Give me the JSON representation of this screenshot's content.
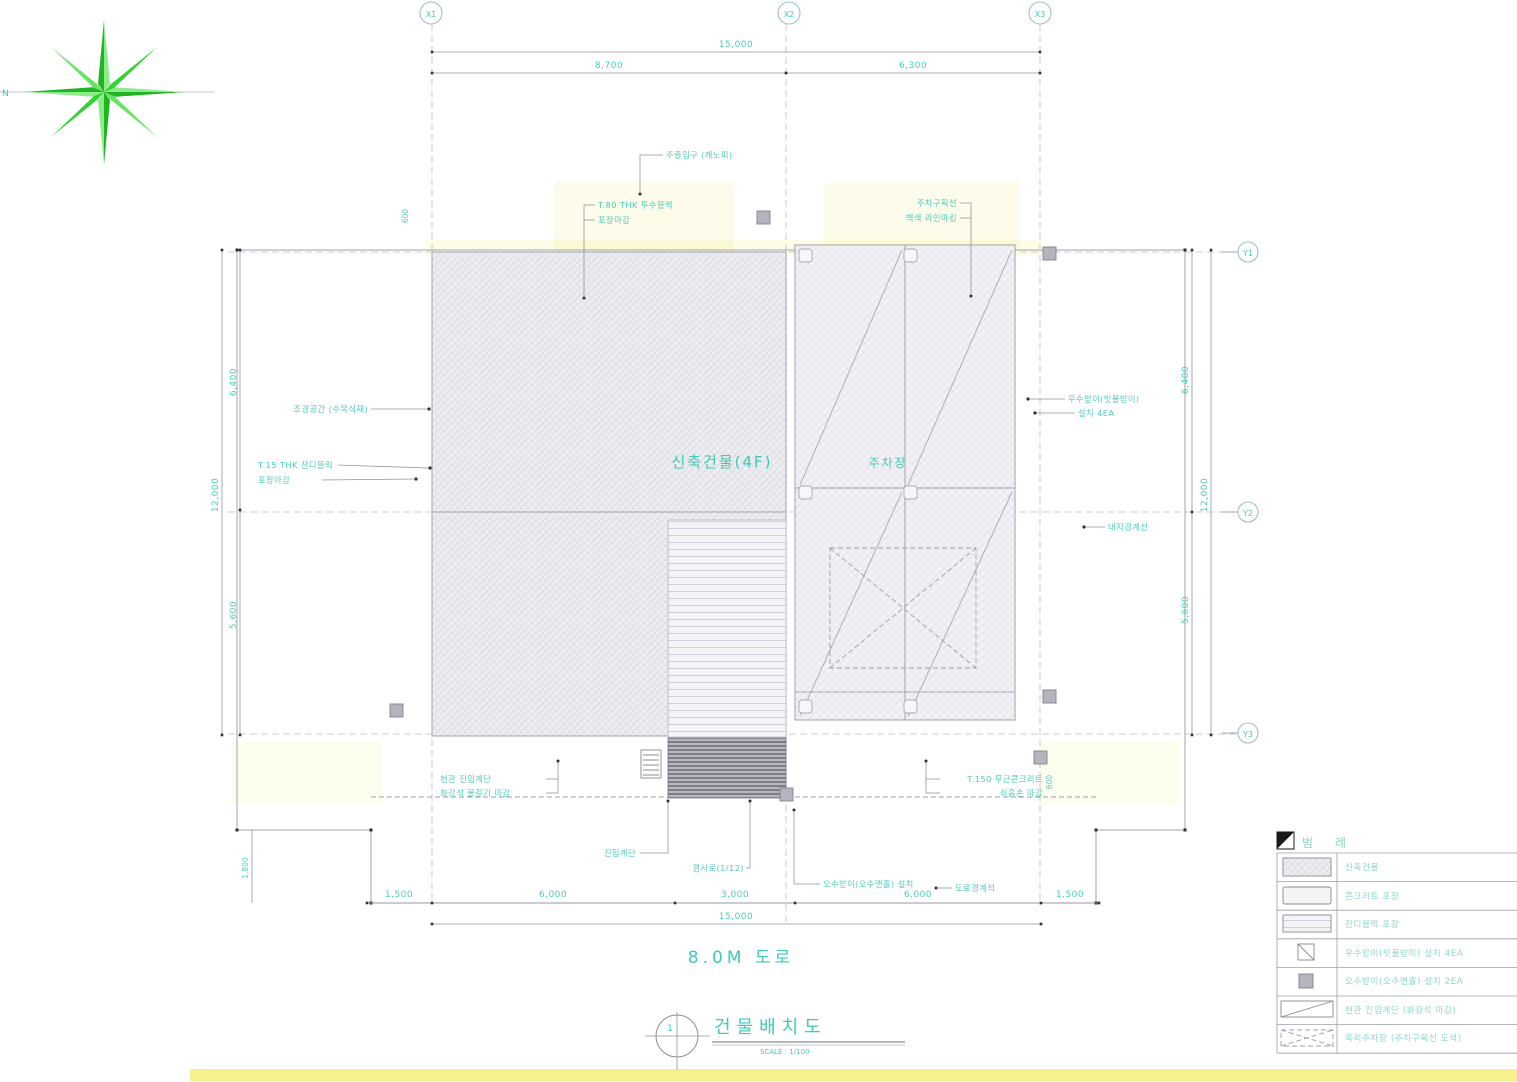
{
  "titles": {
    "road": "8.0M 도로",
    "drawing": "건물배치도",
    "scale": "SCALE : 1/100",
    "sheet_no": "1"
  },
  "compass": {
    "north_label": "N"
  },
  "grid": {
    "x": [
      "X1",
      "X2",
      "X3"
    ],
    "y": [
      "Y1",
      "Y2",
      "Y3"
    ]
  },
  "plan": {
    "building_label": "신축건물(4F)",
    "parking_label": "주차장"
  },
  "dims": {
    "top_total": "15,000",
    "top_a": "8,700",
    "top_b": "6,300",
    "bottom_1": "1,500",
    "bottom_2": "6,000",
    "bottom_3": "3,000",
    "bottom_4": "6,000",
    "bottom_5": "1,500",
    "bottom_total": "15,000",
    "left_a": "6,400",
    "left_b": "5,600",
    "left_total": "12,000",
    "right_a": "6,400",
    "right_b": "5,600",
    "right_total": "12,000",
    "side_small": "1,800",
    "small_1": "600",
    "small_2": "600"
  },
  "callouts": {
    "c1": "주출입구 (캐노피)",
    "c2a": "T.80 THK 투수블럭",
    "c2b": "포장마감",
    "c3a": "주차구획선",
    "c3b": "백색 라인마킹",
    "c4": "조경공간 (수목식재)",
    "c5a": "T.15 THK 잔디블럭",
    "c5b": "포장마감",
    "c6a": "우수받이(빗물받이)",
    "c6b": "설치 4EA",
    "c7": "대지경계선",
    "c8a": "현관 진입계단",
    "c8b": "화강석 물갈기 마감",
    "c9a": "T.150 무근콘크리트",
    "c9b": "쇠흙손 마감",
    "c10a": "진입계단",
    "c10b": "경사로(1/12)",
    "c11": "오수받이(오수맨홀) 설치",
    "c12": "도로경계석"
  },
  "legend": {
    "header": "범  례",
    "rows": [
      {
        "label": "신축건물"
      },
      {
        "label": "콘크리트 포장"
      },
      {
        "label": "잔디블럭 포장"
      },
      {
        "label": "우수받이(빗물받이) 설치 4EA"
      },
      {
        "label": "오수받이(오수맨홀) 설치 2EA"
      },
      {
        "label": "현관 진입계단 (화강석 마감)"
      },
      {
        "label": "옥외주차장 (주차구획선 도색)"
      }
    ]
  },
  "colors": {
    "accent": "#3ecab8",
    "line": "#8f949c",
    "compass_green": "#2ed52e",
    "highlight": "#f2ee7a"
  }
}
